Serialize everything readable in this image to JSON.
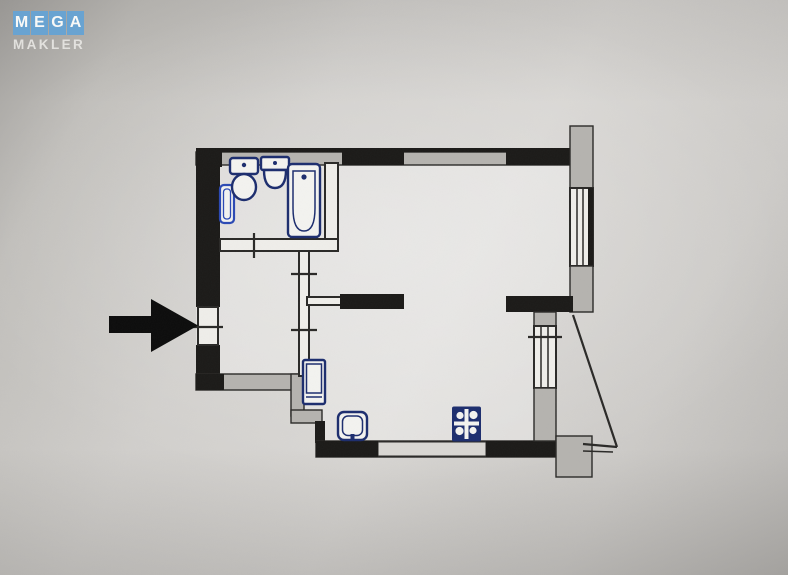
{
  "watermark": {
    "letters": [
      "M",
      "E",
      "G",
      "A"
    ],
    "subtitle": "MAKLER"
  },
  "colors": {
    "logo-blue": "#69a3d1",
    "logo-text": "#f8f8f6",
    "logo-sub": "#e7e6e3",
    "wall-dark": "#1b1a18",
    "wall-gray": "#b5b3af",
    "wall-light": "#d9d7d3",
    "line": "#2a2927",
    "fixture-navy": "#1c2d6e",
    "fixture-blue": "#2b49b4",
    "arrow-black": "#0c0c0c"
  },
  "floorplan": {
    "annotation": "entrance-arrow",
    "bathroom_fixtures": [
      "towel-rail",
      "toilet",
      "washbasin",
      "bathtub"
    ],
    "hall_fixtures": [
      "washing-machine"
    ],
    "kitchen_fixtures": [
      "kitchen-sink",
      "stove"
    ]
  }
}
